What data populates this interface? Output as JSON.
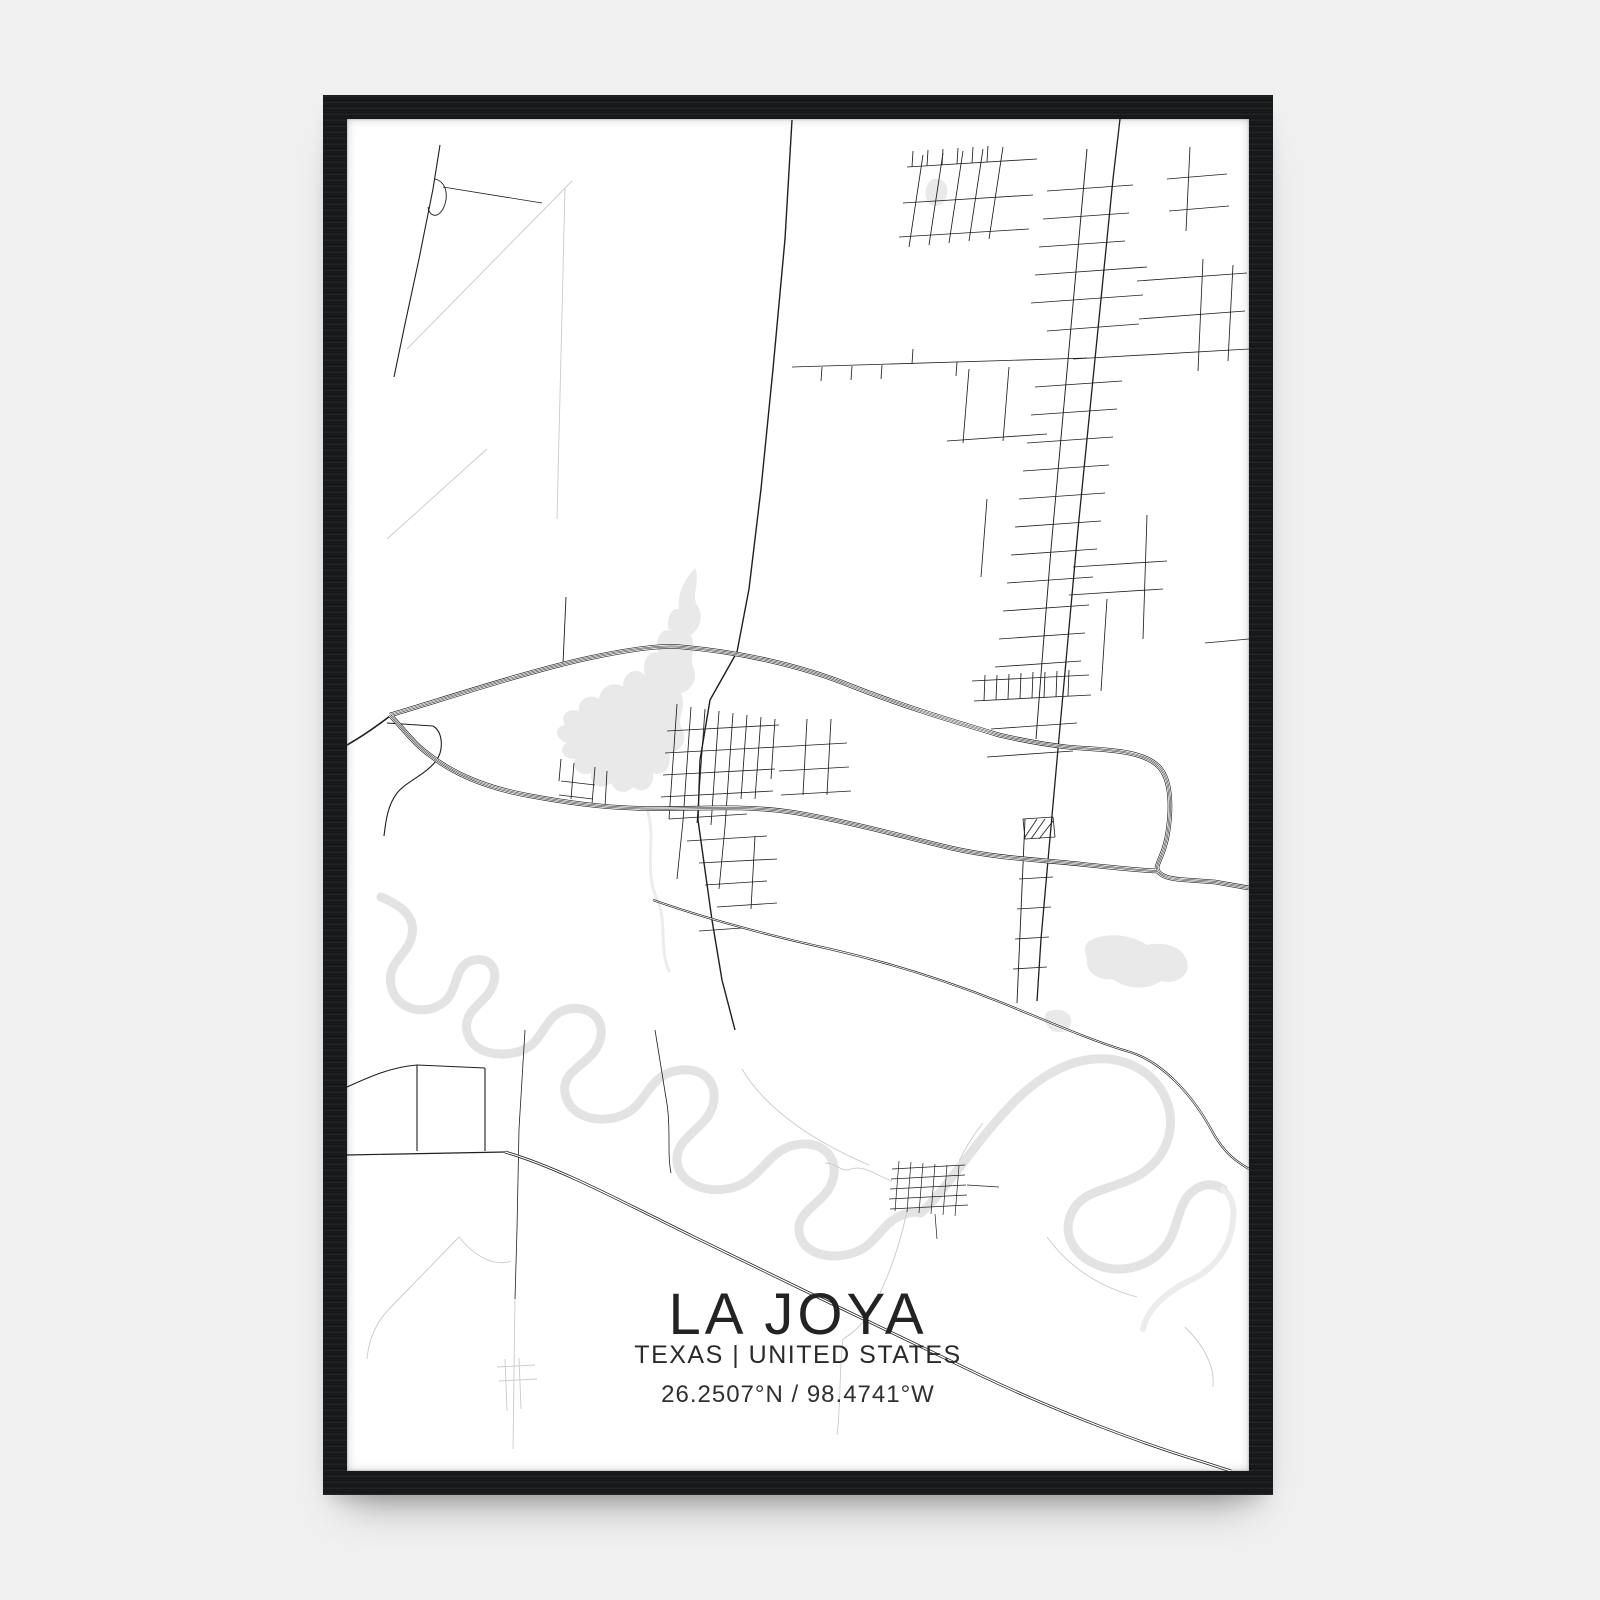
{
  "wall": {
    "description": "light gallery wall"
  },
  "frame": {
    "style": "black wood frame",
    "orientation": "portrait"
  },
  "poster": {
    "title": "LA JOYA",
    "subtitle": "TEXAS | UNITED STATES",
    "coordinates": "26.2507°N / 98.4741°W"
  },
  "map": {
    "type": "minimal-street-map-poster",
    "features": [
      "expressway-83-double-curve",
      "la-joya-lake",
      "rio-grande-meanders",
      "la-joya-town-grid",
      "north-subdivision-ladder-grid",
      "rural-field-roads",
      "small-grid-settlement-south"
    ]
  },
  "colors": {
    "wall": "#f0f0f1",
    "frame": "#17191b",
    "paper": "#ffffff",
    "road": "#1f1f21",
    "road-light": "#c9cacc",
    "water": "#e9e9ea",
    "water2": "#e3e3e4",
    "text": "#232323"
  }
}
